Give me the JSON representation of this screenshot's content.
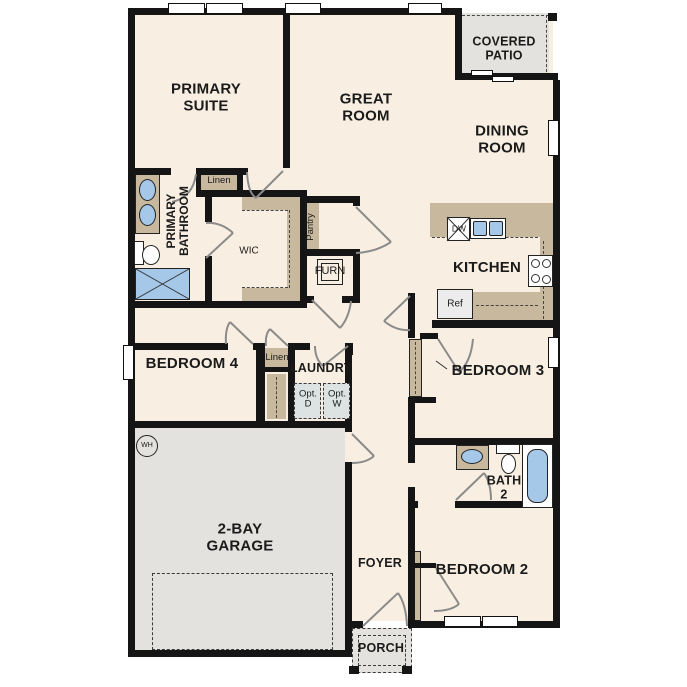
{
  "rooms": {
    "primary_suite": "PRIMARY SUITE",
    "great_room": "GREAT ROOM",
    "covered_patio": "COVERED PATIO",
    "dining_room": "DINING ROOM",
    "kitchen": "KITCHEN",
    "primary_bathroom": "PRIMARY BATHROOM",
    "wic": "WIC",
    "linen_1": "Linen",
    "pantry": "Pantry",
    "furn": "FURN",
    "bedroom_4": "BEDROOM 4",
    "linen_2": "Linen",
    "laundry": "LAUNDRY",
    "bedroom_3": "BEDROOM 3",
    "bath_2": "BATH 2",
    "bedroom_2": "BEDROOM 2",
    "foyer": "FOYER",
    "garage": "2-BAY GARAGE",
    "porch": "PORCH"
  },
  "appliances": {
    "dishwasher": "DW",
    "refrigerator": "Ref",
    "water_heater": "WH",
    "optional_dryer": "Opt. D",
    "optional_washer": "Opt. W"
  },
  "colors": {
    "floor": "#f8efe2",
    "wall": "#151515",
    "casework_tan": "#c8b89d",
    "garage_gray": "#e4e2de",
    "fixture_blue": "#a5c8e8"
  }
}
